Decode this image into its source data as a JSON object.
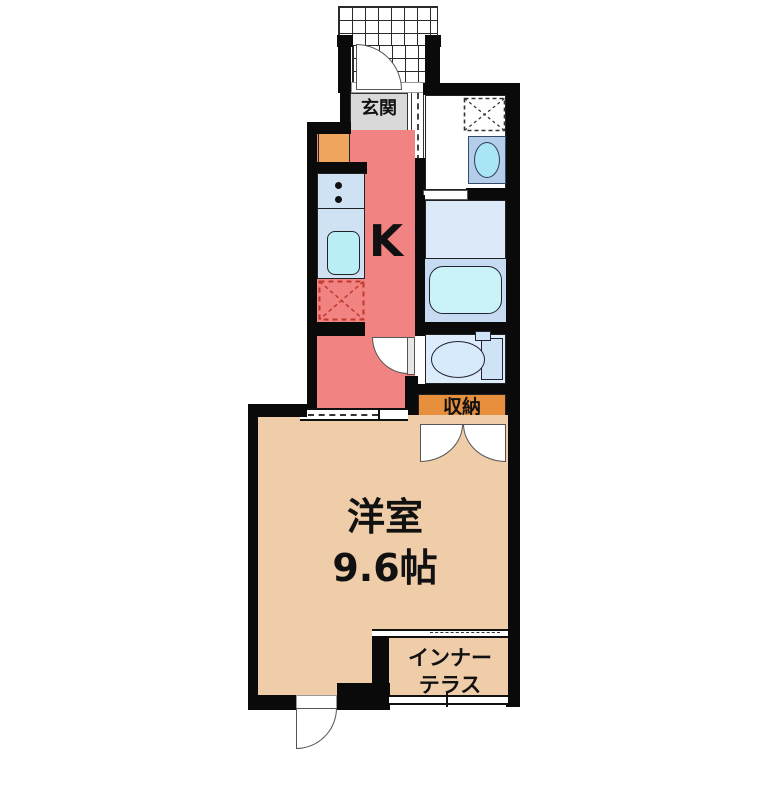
{
  "plan": {
    "type": "apartment-floor-plan",
    "rooms": {
      "entrance": {
        "label": "玄関",
        "color": "#d9d9d9"
      },
      "kitchen": {
        "label": "K",
        "color": "#f18383"
      },
      "washroom": {
        "color": "#ffffff"
      },
      "bathroom": {
        "color": "#dbe9f8"
      },
      "toilet": {
        "color": "#ddecfa"
      },
      "storage": {
        "label": "収納",
        "color": "#e78f3c"
      },
      "main_room": {
        "label_name": "洋室",
        "label_size": "9.6帖",
        "color": "#f0cda9"
      },
      "inner_terrace": {
        "label_line1": "インナー",
        "label_line2": "テラス",
        "color": "#f0cda9"
      }
    },
    "colors": {
      "wall": "#0a0a0a",
      "kitchen_counter": "#cfe2f4",
      "kitchen_sink": "#baeef6",
      "bathtub": "#c9f3f7",
      "bath_lower_zone": "#c6daf1",
      "vanity": "#b3cdeb",
      "vanity_basin": "#a9e5f4",
      "toilet_fixture": "#d7eafc",
      "shoe_cabinet": "#f0a55f",
      "fridge_dashed": "#c0392b"
    },
    "fixtures": [
      "entrance-door",
      "washing-machine-space",
      "vanity-sink",
      "folding-bath-door",
      "bathtub",
      "toilet",
      "toilet-door",
      "stove",
      "kitchen-sink",
      "refrigerator-space",
      "closet-double-doors",
      "sliding-partition",
      "terrace-window",
      "exterior-door"
    ]
  }
}
